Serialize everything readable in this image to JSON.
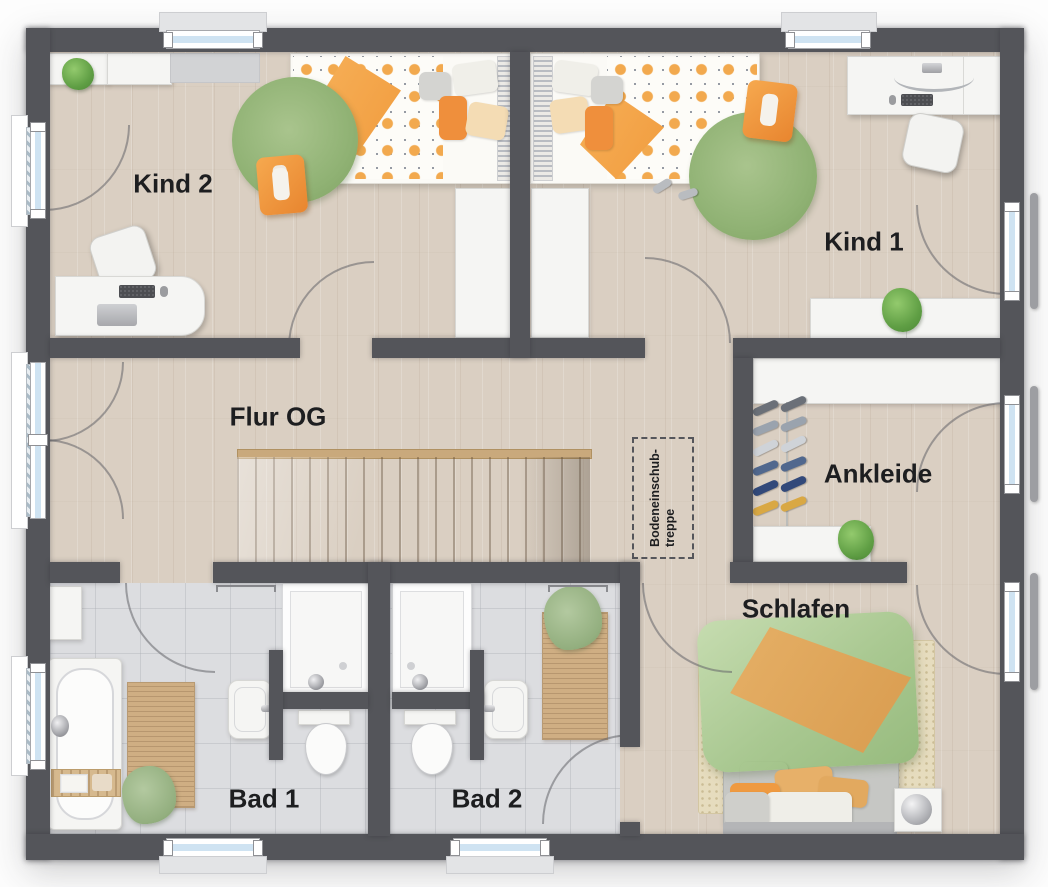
{
  "plan": {
    "kind": "floorplan-top-view",
    "rooms": {
      "kind2": {
        "label": "Kind 2"
      },
      "kind1": {
        "label": "Kind 1"
      },
      "flur": {
        "label": "Flur OG"
      },
      "ankleide": {
        "label": "Ankleide"
      },
      "schlafen": {
        "label": "Schlafen"
      },
      "bad1": {
        "label": "Bad 1"
      },
      "bad2": {
        "label": "Bad 2"
      }
    },
    "annotations": {
      "loft_hatch": {
        "line1": "Bodeneinschub-",
        "line2": "treppe"
      }
    },
    "palette": {
      "wall": "#54555a",
      "wood_floor": "#dacfc2",
      "tile_floor": "#dcdde0",
      "stair_wood": "#cdb797",
      "rug_green": "#90b274",
      "accent_orange": "#efa14d",
      "bed_green": "#a9c891",
      "blanket_tan": "#dfa95e",
      "glazing_blue": "#cfe3f2",
      "railing_gray": "#9d9ea2",
      "furniture_white": "#f5f5f3",
      "label_text": "#1d1e20"
    }
  }
}
